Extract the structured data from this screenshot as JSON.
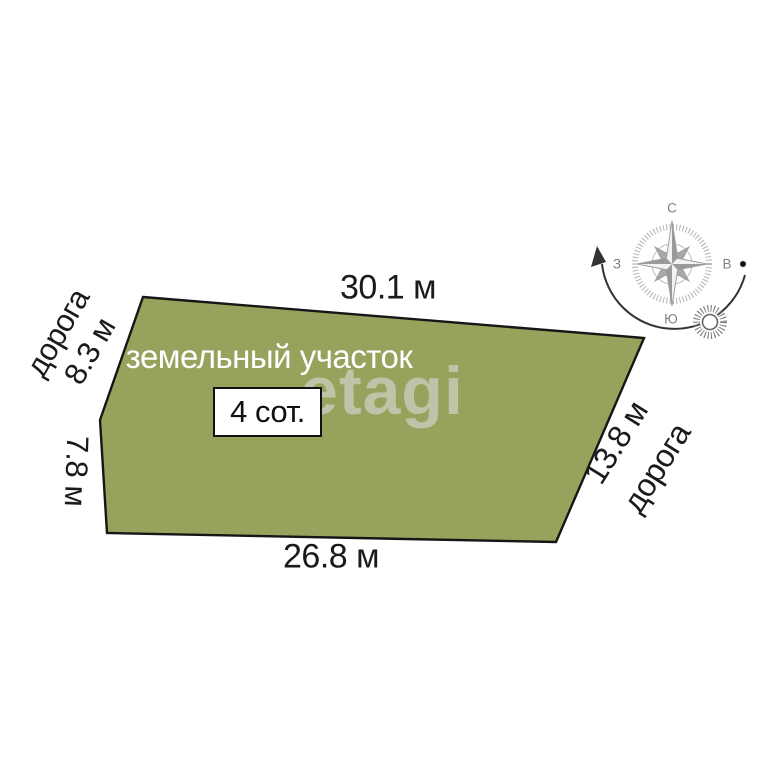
{
  "plot": {
    "name_label": "земельный участок",
    "area_label": "4 сот.",
    "fill_color": "#99a25c",
    "outline_color": "#161616"
  },
  "dimensions": {
    "top": "30.1 м",
    "bottom": "26.8 м",
    "left_upper": "8.3 м",
    "left_lower": "7.8 м",
    "right": "13.8 м"
  },
  "roads": {
    "left": "дорога",
    "right": "дорога"
  },
  "compass": {
    "north": "С",
    "east": "В",
    "south": "Ю",
    "west": "З"
  },
  "watermark": "etagi"
}
